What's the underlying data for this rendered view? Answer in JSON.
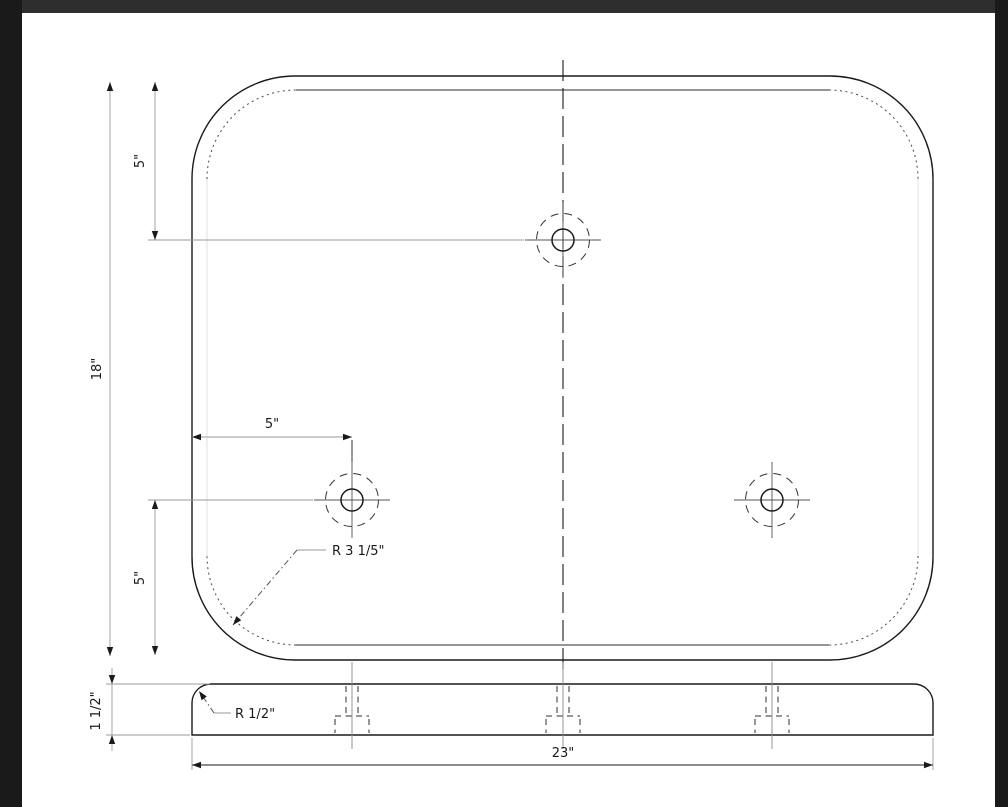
{
  "frame": {
    "outer_color": "#1a1a1a",
    "top_strip_color": "#2e2e2e",
    "canvas_color": "#ffffff"
  },
  "drawing": {
    "line_color": "#1a1a1a",
    "dimension_color": "#9a9a9a",
    "labels": {
      "overall_height": "18\"",
      "top_hole_offset": "5\"",
      "left_hole_offset": "5\"",
      "bottom_hole_offset": "5\"",
      "corner_radius": "R 3 1/5\"",
      "edge_fillet_radius": "R 1/2\"",
      "thickness": "1 1/2\"",
      "overall_width": "23\""
    }
  }
}
